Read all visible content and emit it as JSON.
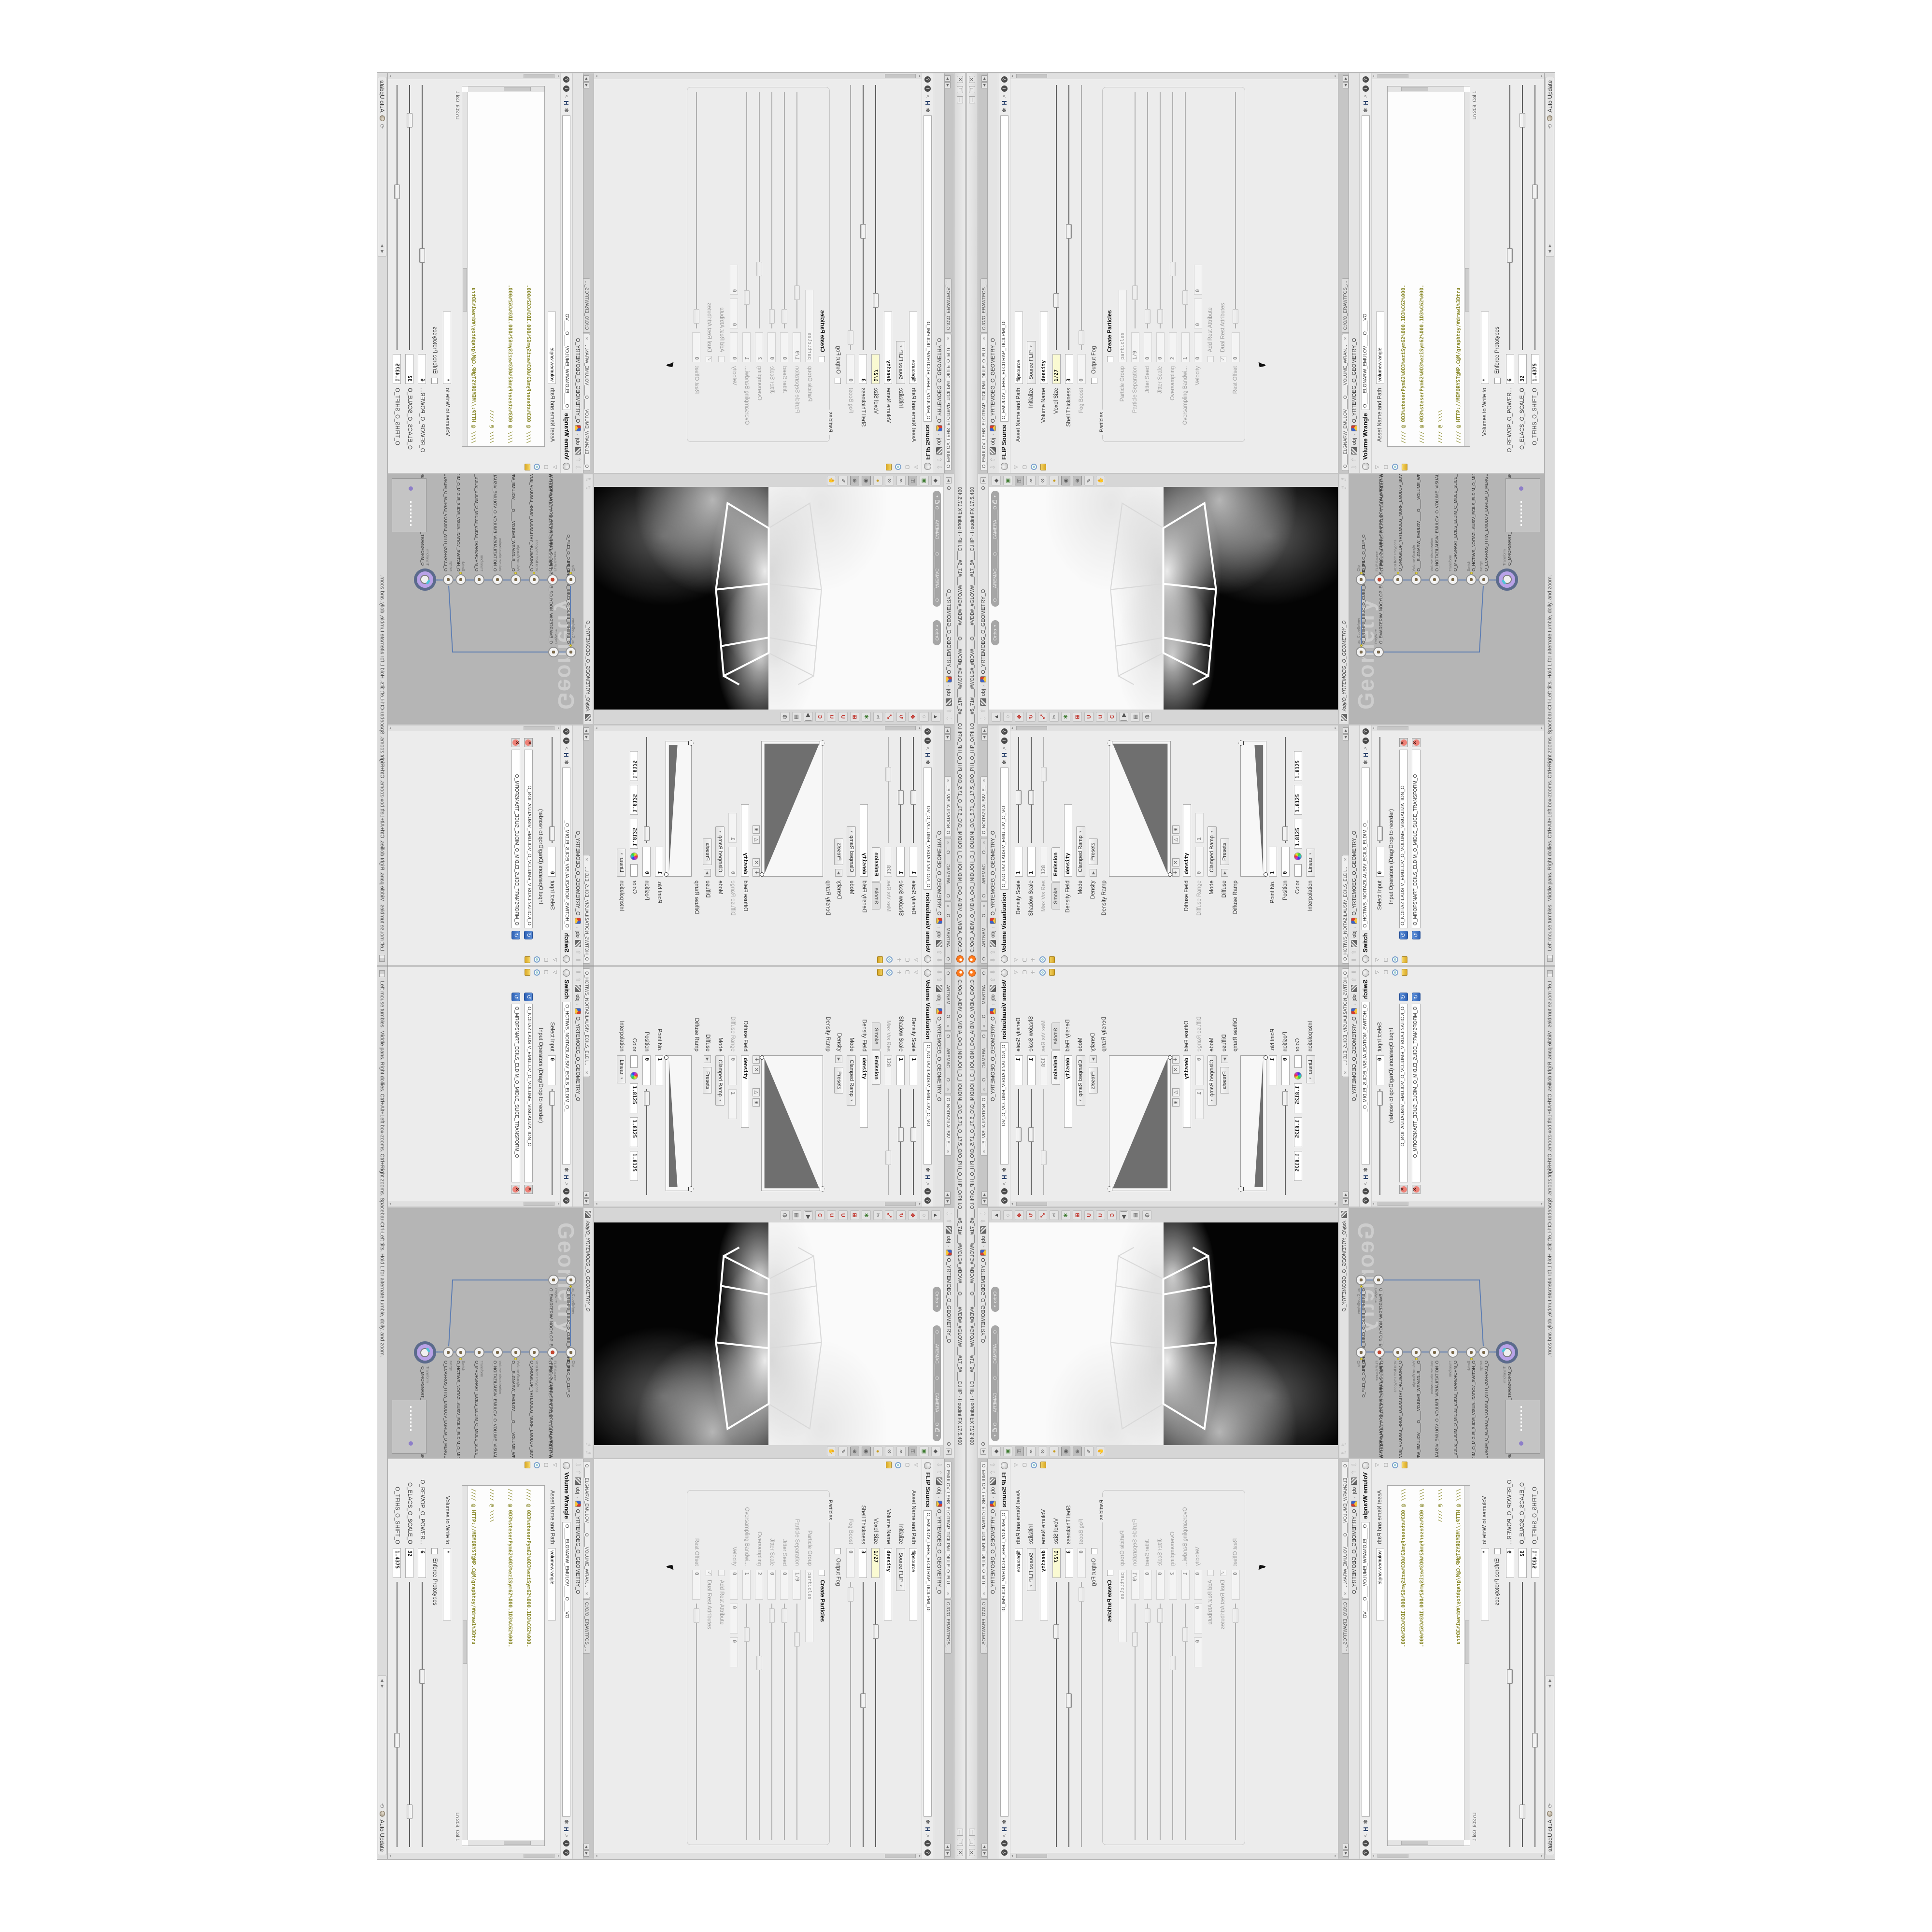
{
  "window": {
    "title": "C:/O/O_AIDIV_O_VIDIA_O/O_INIDUOH_O_HOUDINI_O/O_5.71_O_17.5_O/O_PIH_O_HIP_O/PIH.O___#5_71#___#WOLG#_#BDV#___O____#VDB#_#GLOW#___#17_5#___O.HIP - Houdini FX 17.5.460",
    "minimize": "—",
    "maximize": "❒",
    "close": "✕"
  },
  "statusbar": {
    "hint": "Left mouse tumbles. Middle pans. Right dollies. Ctrl+Alt+Left box-zooms. Ctrl+Right zooms. Spacebar-Ctrl-Left tilts. Hold L for alternate tumble, dolly, and zoom.",
    "auto_update": "Auto Update"
  },
  "breadcrumb": {
    "root": "obj",
    "node": "O_YRTEMOEG_O_GEOMETRY_O"
  },
  "viewport": {
    "projection": "Ortho",
    "camera": "O____AREMAC_____O_____CAMERA____O"
  },
  "network": {
    "path": "/obj/O_YRTEMOEG_O_GEOMETRY_O",
    "watermark": "Geometry",
    "nodes": [
      {
        "type": "as_CubeSphere",
        "name": "O_EREHPS_EBUC_O_CUBE_SPHERE_O"
      },
      {
        "type": "PolyWire",
        "name": "O_EMARFERIW_NOGYLOP_EREHPS_EBUC_O_CUBE_SPHERE_POLYGON_WIREFRAME_O"
      },
      {
        "type": "Clip",
        "name": "O_PILC_O_CLIP_O"
      },
      {
        "type": "FLIP Source",
        "name": "O_EMULOV_LEHS_ELCITRAP_TICILPMI_DIULF_O_FLUID_IMPLICIT_PARTICLE_SHEL_VOLUME_O"
      },
      {
        "type": "VDB from Polygons",
        "name": "O_SNOGILOP_YRTEMOEG_MORF_EMULOV_BDV_O_VDB_VOLUME_FROM_GEOMETRY_POLYGONS_O"
      },
      {
        "type": "Volume Wrangle",
        "name": "O___ELGNARW_EMULOV____O____VOLUME_WRANGLE___O"
      },
      {
        "type": "Volume Visualization",
        "name": "O_NOITAZILAUSIV_EMULOV_O_VOLUME_VISUALIZATION_O"
      },
      {
        "type": "Transform",
        "name": "O_MROFSNART_ECILS_ELDIM_O_MIDLE_SLICE_TRANSFORM_O"
      },
      {
        "type": "Switch",
        "name": "O_HCTIWS_NOITAZILAUSIV_ECILS_ELDIM_O_MIDLE_SLICE_VISUALIZATION_SWITCH_O"
      },
      {
        "type": "Merge",
        "name": "O_ECAFRUS_HTIW_EMULOV_EGREM_O_MERGE_VOLUME_WITH_SURFACE_O"
      },
      {
        "type": "Transform",
        "name": "O_MROFSNART_TLUSER_O_RESULT_TRANSFORM_O"
      }
    ]
  },
  "volvis": {
    "tabs": [
      "O____ARTNAM____O...",
      "O____AREMAC____O...",
      "O_NOITAZILAUSIV_E..."
    ],
    "title": "Volume Visualization",
    "name_field": "O_NOITAZILAUSIV_EMULOV_O_VO",
    "density_scale": {
      "label": "Density Scale",
      "value": "1"
    },
    "shadow_scale": {
      "label": "Shadow Scale",
      "value": "1"
    },
    "max_vis_res": {
      "label": "Max Vis Res",
      "value": "128"
    },
    "mode_tabs": [
      "Smoke",
      "Emission"
    ],
    "density_field": {
      "label": "Density Field",
      "value": "density"
    },
    "density_mode": {
      "label": "Mode",
      "value": "Clamped Ramp"
    },
    "density_presets": {
      "label": "Density",
      "button": "Presets"
    },
    "density_ramp_label": "Density Ramp",
    "diffuse_field": {
      "label": "Diffuse Field",
      "value": "density"
    },
    "diffuse_range": {
      "label": "Diffuse Range",
      "v1": "0",
      "v2": "1"
    },
    "diffuse_mode": {
      "label": "Mode",
      "value": "Clamped Ramp"
    },
    "diffuse_presets": {
      "label": "Diffuse",
      "button": "Presets"
    },
    "diffuse_ramp_label": "Diffuse Ramp",
    "point_no": {
      "label": "Point No.",
      "value": "1"
    },
    "position": {
      "label": "Position",
      "value": "0"
    },
    "color": {
      "label": "Color",
      "r": "1.8125",
      "g": "1.8125",
      "b": "1.8125"
    },
    "interpolation": {
      "label": "Interpolation",
      "value": "Linear"
    }
  },
  "switchpane": {
    "tab": "O_HCTIWS_NOITAZILAUSIV_ECILS_ELDIM_O_MIDLE_SLICE_VISUALIZATION...",
    "title": "Switch",
    "name_field": "O_HCTIWS_NOITAZILAUSIV_ECILS_ELDIM_O_",
    "select_input": {
      "label": "Select Input",
      "value": "0"
    },
    "operators_label": "Input Operators (Drag/Drop to reorder)",
    "inputs": [
      "O_NOITAZILAUSIV_EMULOV_O_VOLUME_VISUALIZATION_O",
      "O_MROFSNART_ECILS_ELDIM_O_MIDLE_SLICE_TRANSFORM_O"
    ]
  },
  "flip": {
    "tabs": [
      "O_EMULOV_LEHS_ELCITRAP_TICILPMI_DIULF_O_FLUID_IMPLICIT_PARTICLE...",
      "C:/O/O_ERAWTFOS_..."
    ],
    "title": "FLIP Source",
    "name_field": "O_EMULOV_LEHS_ELCITRAP_TICILPMI_DI",
    "asset": {
      "label": "Asset Name and Path",
      "value": "flipsource"
    },
    "initialize": {
      "label": "Initialize",
      "value": "Source FLIP"
    },
    "volume_name": {
      "label": "Volume Name",
      "value": "density"
    },
    "voxel_size": {
      "label": "Voxel Size",
      "value": "1/27"
    },
    "shell_thickness": {
      "label": "Shell Thickness",
      "value": "3"
    },
    "fog_boost": {
      "label": "Fog Boost",
      "value": "0"
    },
    "output_fog": "Output Fog",
    "particles_group": "Particles",
    "create_particles": "Create Particles",
    "particle_group": {
      "label": "Particle Group",
      "value": "particles"
    },
    "particle_separation": {
      "label": "Particle Separation",
      "value": "1/9"
    },
    "jitter_seed": {
      "label": "Jitter Seed",
      "value": "0"
    },
    "jitter_scale": {
      "label": "Jitter Scale",
      "value": "0"
    },
    "oversampling": {
      "label": "Oversampling",
      "value": "2"
    },
    "oversampling_bandwidth": {
      "label": "Oversampling Bandwi...",
      "value": "1"
    },
    "velocity": {
      "label": "Velocity",
      "v1": "0",
      "v2": "0",
      "v3": "0"
    },
    "add_rest": "Add Rest Attribute",
    "dual_rest": "Dual Rest Attributes",
    "rest_offset": {
      "label": "Rest Offset",
      "value": "0"
    }
  },
  "wrangle": {
    "tabs": [
      "O____ELGNARW_EMULOV____O____VOLUME_WRANGL...",
      "C:/O/O_ERAWTFOS_..."
    ],
    "title": "Volume Wrangle",
    "name_field": "O____ELGNARW_EMULOV____O____VO",
    "asset": {
      "label": "Asset Name and Path",
      "value": "volumewrangle"
    },
    "code": [
      "//// @ 0D3%steserPym62%0D3%eziSym62%000.1D3%C62%000.",
      "//// @ 0D3%steserPym62%0D3%eziSym62%000.1D3%C62%000.",
      "//// @ \\\\\\\\",
      "//// @ HTTP://MEMORYST@MP.C@M/graphtoy/#draw1%3Dtru",
      "//// @ HTTP://MEMORYST@MP.C@M/graphtoy/#draw1%3Dtru",
      "",
      "@density=((      ((pow((      1./ (1.-cla",
      "",
      "//// @ 0D3%steserPym62%0D3%eziSym62%000.1D3%C62%000.",
      "//// @ 0D3%steserPym62%0D3%eziSym62%000.1D3%C62%000.",
      "//// @ \\\\\\\\",
      "//// @ HTTP://MEMORYST@MP.C@M/graphtoy/#draw1%3Dtru",
      "//// @ HTTP://MEMORYST@MP.C@M/graphtoy/#draw1%3Dtru"
    ],
    "cursor_pos": "Ln 209, Col 1",
    "volumes": {
      "label": "Volumes to Write to",
      "value": "*"
    },
    "enforce": "Enforce Prototypes",
    "power": {
      "label": "O_REWOP_O_POWER...",
      "value": "6"
    },
    "scale": {
      "label": "O_ELACS_O_SCALE_O",
      "value": "32"
    },
    "shift": {
      "label": "O_TFIHS_O_SHIFT_O",
      "value": "1.4375"
    }
  },
  "icons": {
    "close": "✕",
    "gear": "✽",
    "h_badge": "H",
    "search": "⌕",
    "info": "i",
    "help": "?",
    "left": "◀",
    "right": "▶",
    "up": "⇧",
    "down": "⇩",
    "tri": "▾",
    "sync": "⟲",
    "pin": "⊙"
  }
}
